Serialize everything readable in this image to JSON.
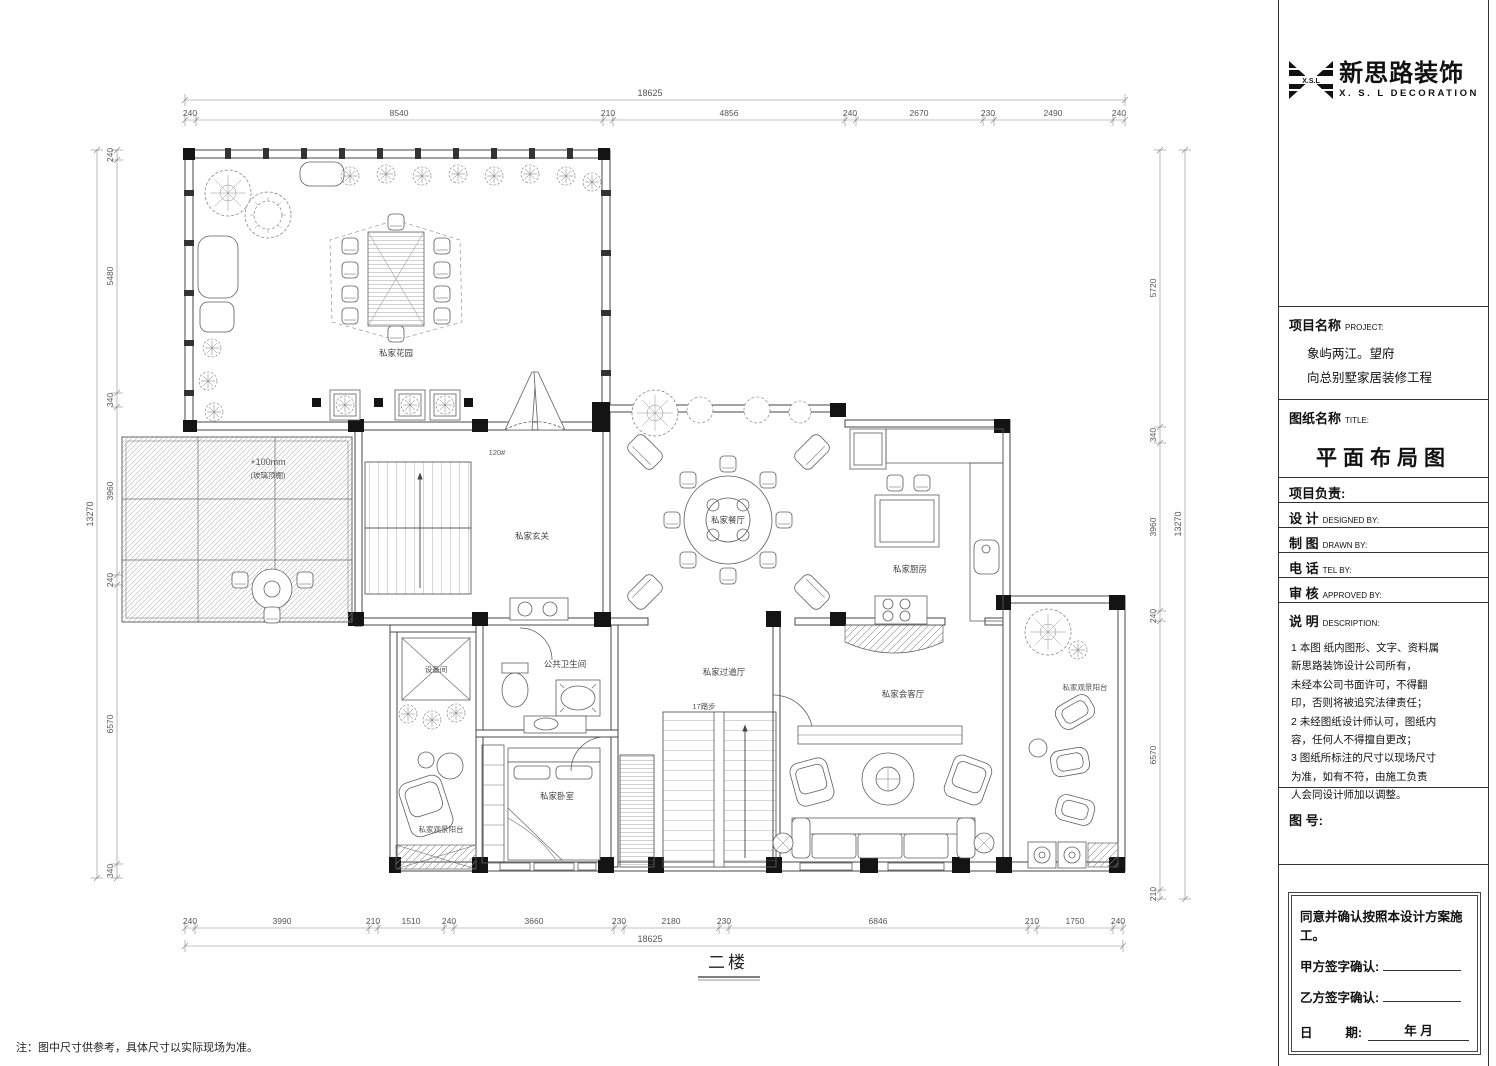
{
  "logo": {
    "mark": "X.S.L",
    "brand_cn": "新思路装饰",
    "brand_en": "X. S. L  DECORATION"
  },
  "title_block": {
    "project_label": "项目名称",
    "project_label_en": "PROJECT:",
    "project_line1": "象屿两江。望府",
    "project_line2": "向总别墅家居装修工程",
    "sheet_label": "图纸名称",
    "sheet_label_en": "TITLE:",
    "sheet_title": "平面布局图",
    "leader_label": "项目负责:",
    "rows": [
      {
        "cn": "设  计",
        "en": "DESIGNED BY:"
      },
      {
        "cn": "制  图",
        "en": "DRAWN BY:"
      },
      {
        "cn": "电  话",
        "en": "TEL BY:"
      },
      {
        "cn": "审  核",
        "en": "APPROVED BY:"
      }
    ],
    "desc_cn": "说  明",
    "desc_en": "DESCRIPTION:",
    "notes": [
      "1 本图 纸内图形、文字、资料属",
      "   新思路装饰设计公司所有，",
      "   未经本公司书面许可，不得翻",
      "   印，否则将被追究法律责任；",
      "2 未经图纸设计师认可，图纸内",
      "   容，任何人不得擅自更改；",
      "3 图纸所标注的尺寸以现场尺寸",
      "   为准，如有不符，由施工负责",
      "   人会同设计师加以调整。"
    ],
    "figure_no_label": "图 号:",
    "agreement": "同意并确认按照本设计方案施工。",
    "party_a_label": "甲方签字确认:",
    "party_b_label": "乙方签字确认:",
    "date_label_left": "日",
    "date_label_right": "期:",
    "date_suffix": "年   月"
  },
  "plan": {
    "floor_title": "二楼",
    "bottom_note": "注：图中尺寸供参考，具体尺寸以实际现场为准。",
    "rooms": {
      "garden": "私家花园",
      "foyer": "私家玄关",
      "dining": "私家餐厅",
      "kitchen": "私家厨房",
      "equipment": "设备间",
      "bathroom": "公共卫生间",
      "hallway": "私家过道厅",
      "living": "私家会客厅",
      "balcony_right": "私家观景阳台",
      "bedroom": "私家卧室",
      "balcony_left": "私家观景阳台"
    },
    "annotations": {
      "elevation": "+100mm",
      "elevation_note": "(玻璃顶棚)",
      "stair_steps": "17踏步",
      "stair_mark": "120#"
    }
  },
  "dims": {
    "top_overall": "18625",
    "top": [
      "240",
      "8540",
      "210",
      "4856",
      "240",
      "2670",
      "230",
      "2490",
      "240"
    ],
    "bottom_overall": "18625",
    "bottom": [
      "240",
      "3990",
      "210",
      "1510",
      "240",
      "3660",
      "230",
      "2180",
      "230",
      "6846",
      "210",
      "1750",
      "240"
    ],
    "left_overall": "13270",
    "left": [
      "240",
      "5480",
      "340",
      "3960",
      "240",
      "6570",
      "340"
    ],
    "right_overall": "13270",
    "right": [
      "5720",
      "340",
      "3960",
      "240",
      "6570",
      "210"
    ]
  }
}
